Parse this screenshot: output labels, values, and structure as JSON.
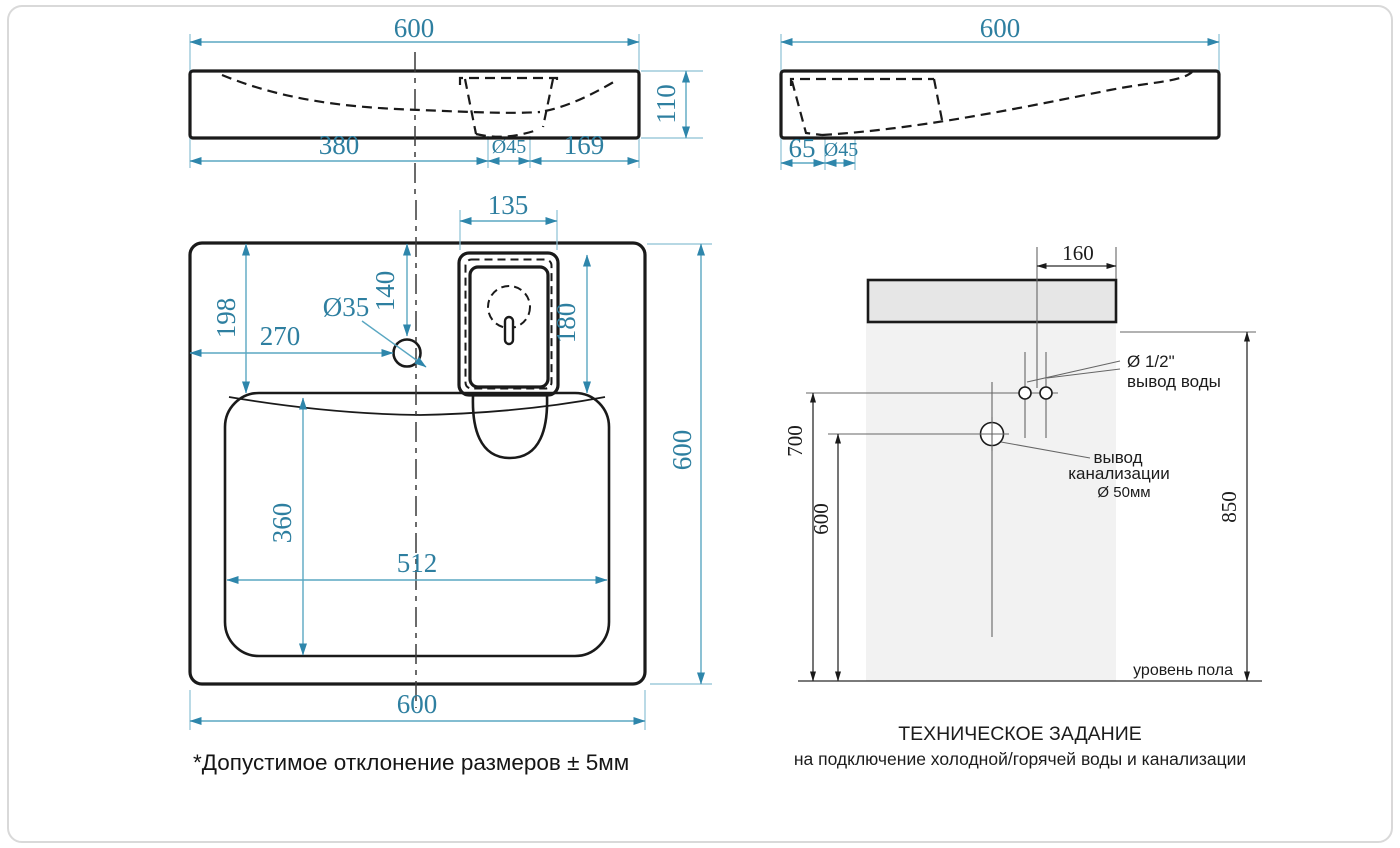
{
  "colors": {
    "dimension_text": "#2e7fa0",
    "dimension_line": "#5aa7c2",
    "drawing_line": "#1a1a1a",
    "slab_fill": "#e6e6e6",
    "wall_fill": "#f2f2f2"
  },
  "front_view": {
    "width_top": "600",
    "height": "110",
    "left_to_drain": "380",
    "drain_diameter": "Ø45",
    "drain_to_right": "169"
  },
  "side_view": {
    "width_top": "600",
    "front_offset": "65",
    "drain_diameter": "Ø45"
  },
  "plan_view": {
    "overflow_width": "135",
    "faucet_from_top": "140",
    "basin_from_top": "198",
    "faucet_from_left": "270",
    "faucet_hole_diameter": "Ø35",
    "overflow_length": "180",
    "depth_right": "600",
    "basin_depth": "360",
    "basin_width": "512",
    "width_bottom": "600"
  },
  "installation": {
    "offset_160": "160",
    "water_height": "700",
    "sewer_height": "600",
    "total_height": "850",
    "water_diameter": "Ø 1/2\"",
    "water_label": "вывод воды",
    "sewer_label_line1": "вывод",
    "sewer_label_line2": "канализации",
    "sewer_diameter": "Ø 50мм",
    "floor_label": "уровень пола",
    "title": "ТЕХНИЧЕСКОЕ ЗАДАНИЕ",
    "subtitle": "на подключение холодной/горячей воды и канализации"
  },
  "note": "*Допустимое отклонение размеров ± 5мм"
}
